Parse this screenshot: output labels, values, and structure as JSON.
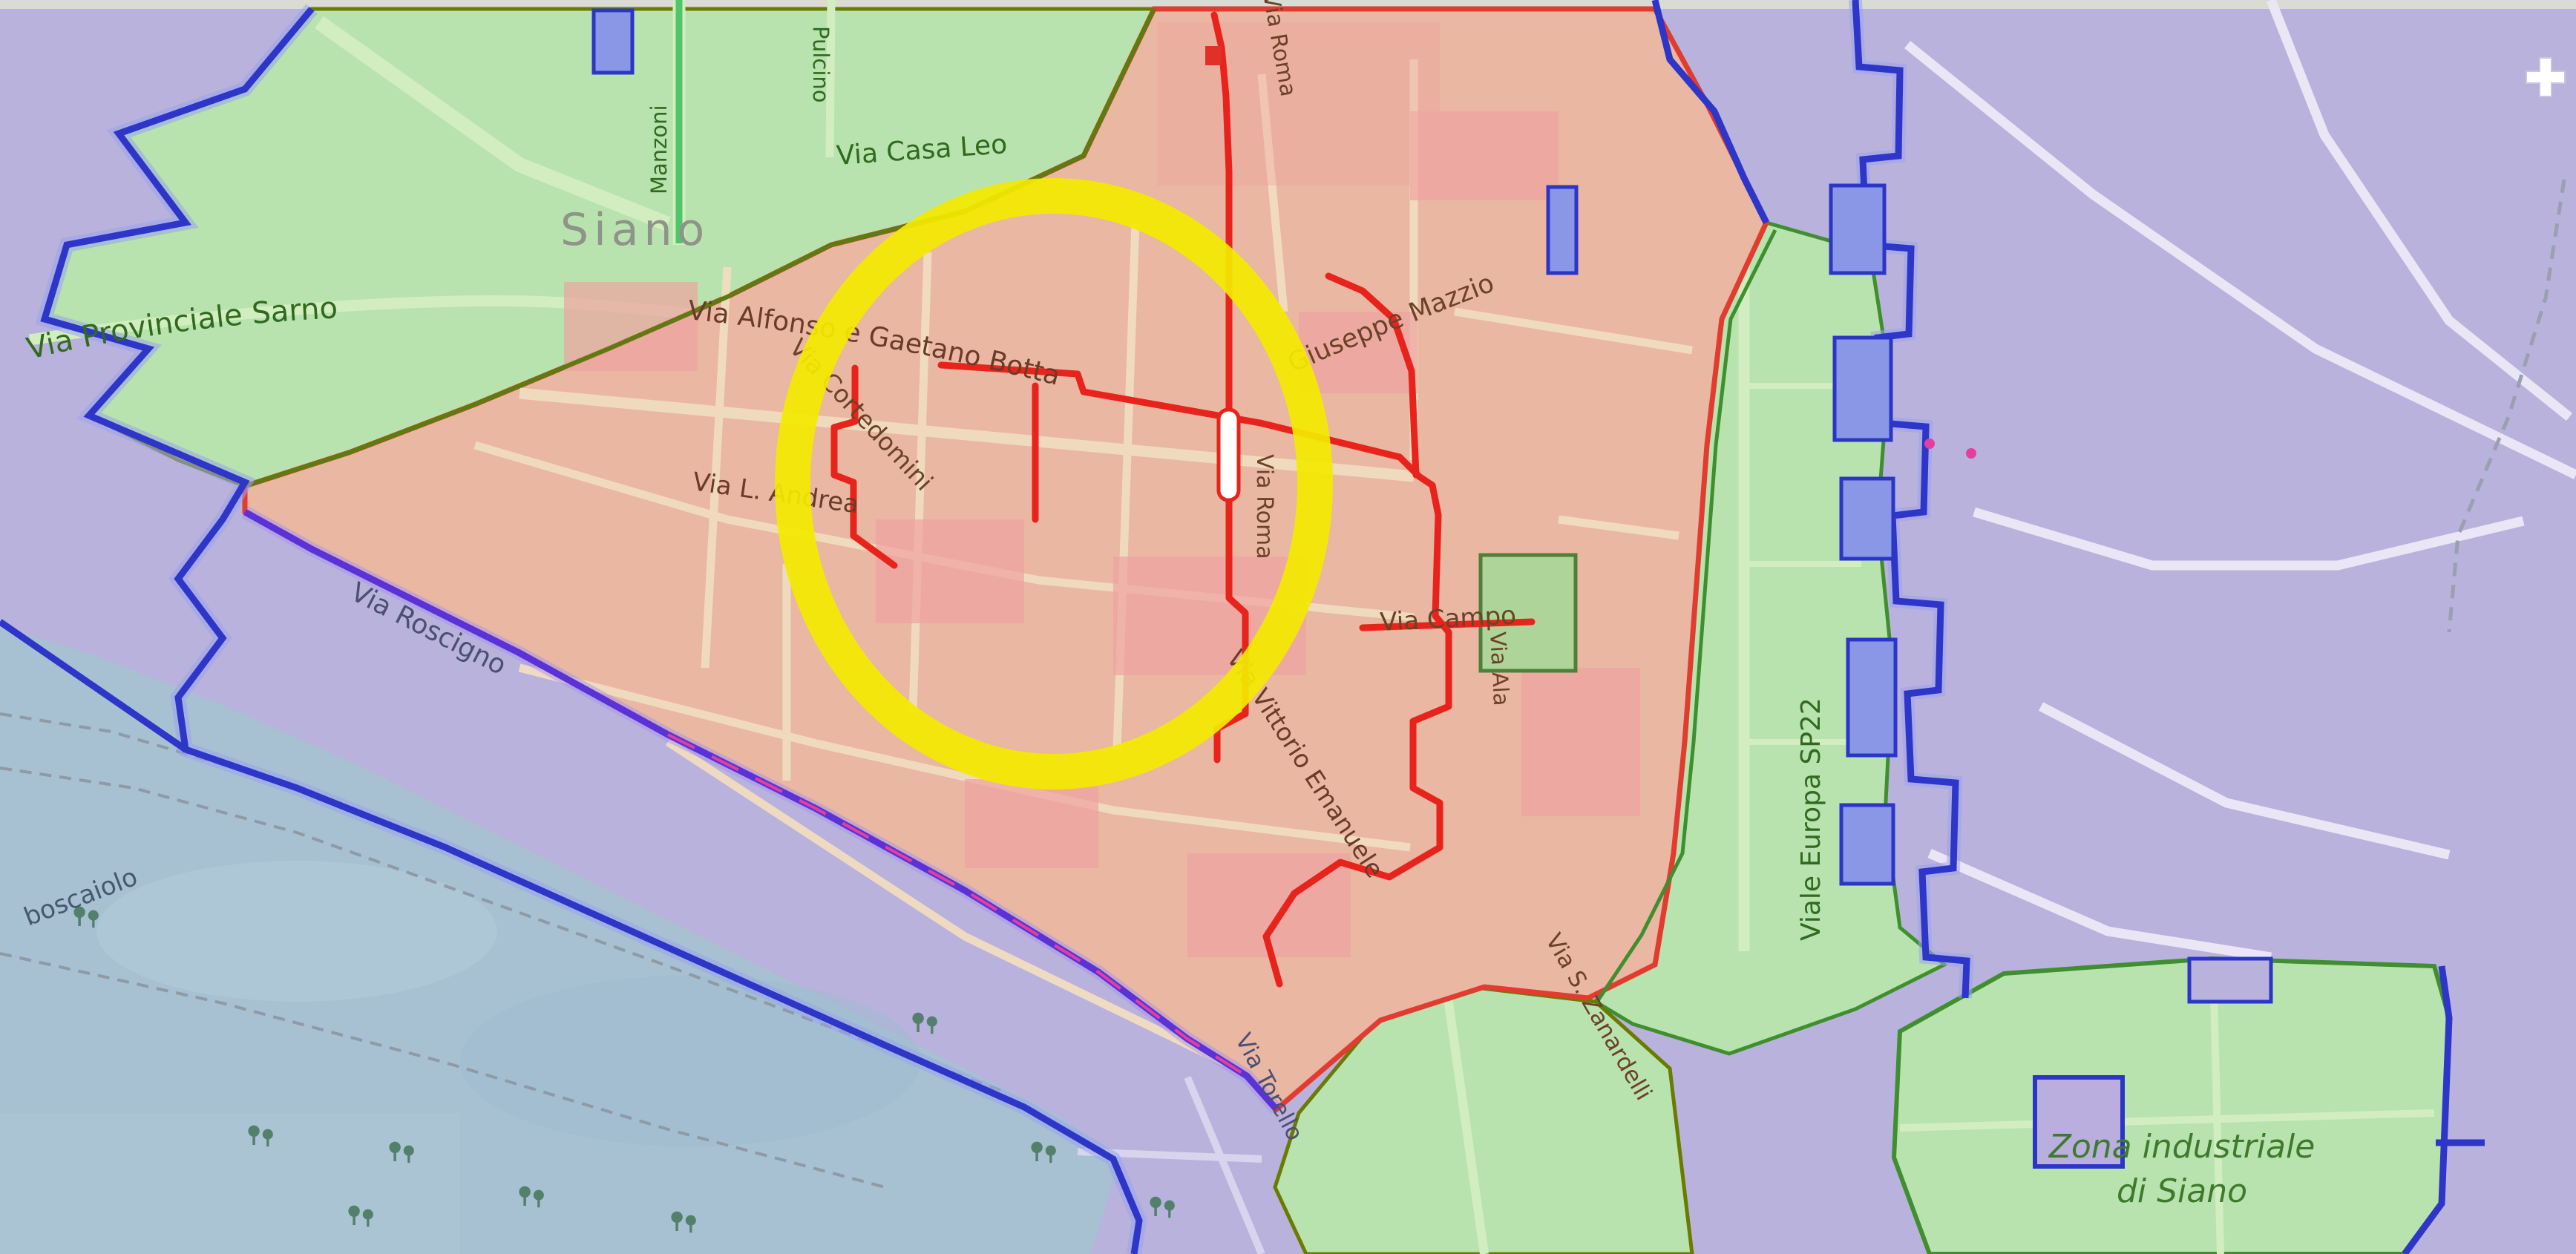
{
  "map": {
    "view": "street map of Siano with zone overlays and highlight annotation",
    "place_labels": {
      "city": "Siano",
      "locality": "boscaiolo",
      "industrial_line1": "Zona industriale",
      "industrial_line2": "di Siano"
    },
    "street_labels": [
      {
        "id": "via-provinciale-sarno",
        "text": "Via Provinciale Sarno"
      },
      {
        "id": "via-casa-leo",
        "text": "Via Casa Leo"
      },
      {
        "id": "manzoni",
        "text": "Manzoni"
      },
      {
        "id": "pulcino",
        "text": "Pulcino"
      },
      {
        "id": "via-cortedomini",
        "text": "Via Cortedomini"
      },
      {
        "id": "via-alfonso-e-gaetano-botta",
        "text": "Via Alfonso e Gaetano Botta"
      },
      {
        "id": "via-l-andrea",
        "text": "Via L. Andrea"
      },
      {
        "id": "giuseppe-mazzio",
        "text": "Giuseppe Mazzio"
      },
      {
        "id": "via-roma",
        "text": "Via Roma"
      },
      {
        "id": "via-campo",
        "text": "Via Campo"
      },
      {
        "id": "via-vittorio-emanuele",
        "text": "Via Vittorio Emanuele"
      },
      {
        "id": "via-ala",
        "text": "Via Ala"
      },
      {
        "id": "viale-europa-sp22",
        "text": "Viale Europa SP22"
      },
      {
        "id": "via-roscigno",
        "text": "Via Roscigno"
      },
      {
        "id": "via-torello",
        "text": "Via Torello"
      },
      {
        "id": "via-s-zanardelli",
        "text": "Via S. Zanardelli"
      }
    ],
    "zones": [
      {
        "name": "town-center-zone",
        "fill": "#e9b7a2",
        "border": "#e23b30"
      },
      {
        "name": "green-zone-northwest",
        "fill": "#b9e3ae",
        "border": "#5f7a10"
      },
      {
        "name": "green-corridor-east",
        "fill": "#b9e3ae",
        "border": "#3f8f2f"
      },
      {
        "name": "green-zone-south",
        "fill": "#b9e3ae",
        "border": "#6b7a00"
      },
      {
        "name": "industrial-zone",
        "fill": "#b9e3ae",
        "border": "#3f8f2f"
      },
      {
        "name": "park-area-southwest",
        "fill": "#a7c0d2",
        "border": "#2d36c8"
      },
      {
        "name": "background",
        "fill": "#b8b2dc",
        "border": ""
      }
    ],
    "boundaries": {
      "municipal_blue": "#2d36c8",
      "purple_magenta": "#5a32d8",
      "magenta_accent": "#e23fa0"
    },
    "route_color": "#e8231c",
    "annotation": {
      "type": "highlight-ellipse",
      "color": "#f3ea00"
    },
    "icons": [
      {
        "name": "tree-icon",
        "count": 9
      },
      {
        "name": "hospital-cross-icon",
        "count": 1
      },
      {
        "name": "poi-dot-icon",
        "count": 2
      },
      {
        "name": "route-marker-capsule",
        "count": 1
      }
    ]
  }
}
